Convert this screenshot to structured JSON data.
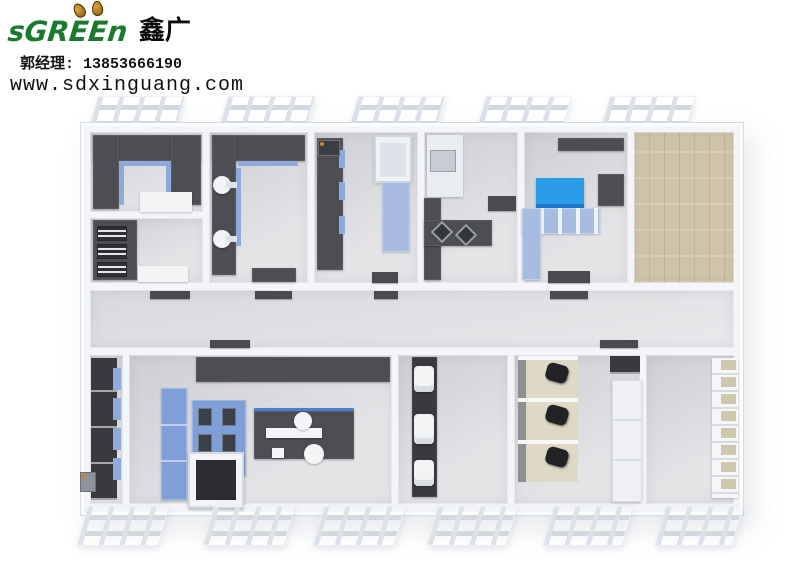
{
  "branding": {
    "logo_latin": "sGREEn",
    "logo_cjk": "鑫广",
    "contact": "郭经理: 13853666190",
    "website": "www.sdxinguang.com"
  },
  "palette": {
    "logo-green": "#1b7a2e",
    "wall": "#f3f5f9",
    "wall-edge": "#d6dbe3",
    "floor-a": "#cdced3",
    "floor-b": "#e4e4e7",
    "bench": "#4d4d52",
    "bench-deep": "#39393e",
    "blue": "#8ea9da",
    "blue-vivid": "#7f9fd8",
    "blue-light": "#a8bce2",
    "accent-blue": "#2b9de8",
    "wood": "#d0c4a8",
    "desk": "#ded8c6",
    "chair": "#232326",
    "white-equip": "#f4f5f7",
    "shelf-item": "#cfc7ae"
  }
}
